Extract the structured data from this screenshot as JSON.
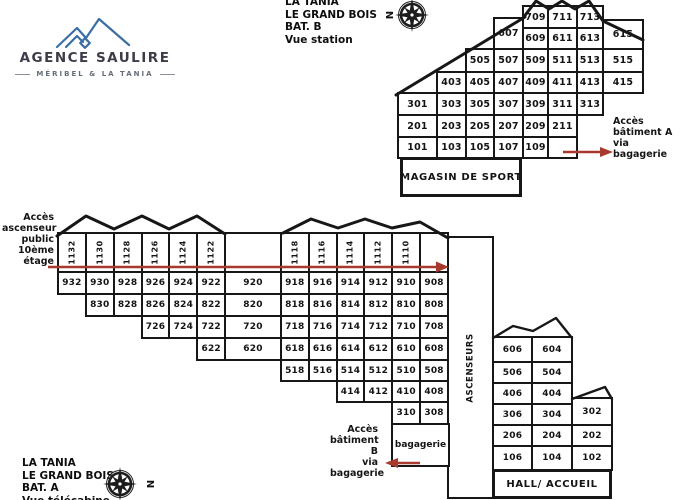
{
  "brand": {
    "name": "AGENCE SAULIRE",
    "tagline": "MÉRIBEL & LA TANIA"
  },
  "legend_top": {
    "lines": [
      "LA TANIA",
      "LE GRAND BOIS",
      "BAT. B",
      "Vue station"
    ]
  },
  "legend_bottom": {
    "lines": [
      "LA TANIA",
      "LE GRAND BOIS",
      "BAT. A",
      "Vue télécabine"
    ]
  },
  "compass": {
    "north_label": "N"
  },
  "notes": {
    "public_elevator": {
      "lines": [
        "Accès",
        "ascenseur",
        "public",
        "10ème",
        "étage"
      ]
    },
    "access_building_a": {
      "lines": [
        "Accès",
        "bâtiment A",
        "via",
        "bagagerie"
      ]
    },
    "access_building_b": {
      "lines": [
        "Accès",
        "bâtiment B",
        "via",
        "bagagerie"
      ]
    }
  },
  "colors": {
    "line": "#171717",
    "arrow": "#a8392e",
    "brand_blue": "#3a6ea5"
  },
  "building_b": {
    "name": "BAT. B",
    "shop_label": "MAGASIN DE SPORT",
    "rows": [
      {
        "row": 7,
        "start": 5,
        "cells": [
          "709",
          "711",
          "713"
        ]
      },
      {
        "row": 6,
        "start": 5,
        "cells": [
          "609",
          "611",
          "613"
        ]
      },
      {
        "row": 5,
        "start": 3,
        "cells": [
          "505",
          "507",
          "509",
          "511",
          "513",
          "515"
        ]
      },
      {
        "row": 4,
        "start": 2,
        "cells": [
          "403",
          "405",
          "407",
          "409",
          "411",
          "413",
          "415"
        ]
      },
      {
        "row": 3,
        "start": 1,
        "cells": [
          "301",
          "303",
          "305",
          "307",
          "309",
          "311",
          "313"
        ]
      },
      {
        "row": 2,
        "start": 1,
        "cells": [
          "201",
          "203",
          "205",
          "207",
          "209",
          "211"
        ]
      },
      {
        "row": 1,
        "start": 1,
        "cells": [
          "101",
          "103",
          "105",
          "107",
          "109",
          ""
        ]
      }
    ],
    "tall_cells": [
      {
        "label": "607",
        "col": 4,
        "y": 18,
        "h": 31
      },
      {
        "label": "615",
        "col": 8,
        "y": 20,
        "h": 29
      }
    ]
  },
  "building_a": {
    "name": "BAT. A",
    "elevators_label": "ASCENSEURS",
    "luggage_label": "bagagerie",
    "hall_label": "HALL/ ACCUEIL",
    "rows": [
      {
        "row": 11,
        "start": 1,
        "vertical": true,
        "cells": [
          "1132",
          "1130",
          "1128",
          "1126",
          "1124",
          "1122",
          {
            "t": "",
            "s": 2
          },
          "1118",
          "1116",
          "1114",
          "1112",
          "1110",
          ""
        ]
      },
      {
        "row": 9,
        "start": 1,
        "cells": [
          "932",
          "930",
          "928",
          "926",
          "924",
          "922",
          {
            "t": "920",
            "s": 2
          },
          "918",
          "916",
          "914",
          "912",
          "910",
          "908"
        ]
      },
      {
        "row": 8,
        "start": 2,
        "cells": [
          "830",
          "828",
          "826",
          "824",
          "822",
          {
            "t": "820",
            "s": 2
          },
          "818",
          "816",
          "814",
          "812",
          "810",
          "808"
        ]
      },
      {
        "row": 7,
        "start": 4,
        "cells": [
          "726",
          "724",
          "722",
          {
            "t": "720",
            "s": 2
          },
          "718",
          "716",
          "714",
          "712",
          "710",
          "708"
        ]
      },
      {
        "row": 6,
        "start": 6,
        "cells": [
          "622",
          {
            "t": "620",
            "s": 2
          },
          "618",
          "616",
          "614",
          "612",
          "610",
          "608"
        ]
      },
      {
        "row": 5,
        "start": 9,
        "cells": [
          "518",
          "516",
          "514",
          "512",
          "510",
          "508"
        ]
      },
      {
        "row": 4,
        "start": 11,
        "cells": [
          "414",
          "412",
          "410",
          "408"
        ]
      },
      {
        "row": 3,
        "start": 13,
        "cells": [
          "310",
          "308"
        ]
      }
    ],
    "right_wing_rows": [
      {
        "row": 6,
        "cells": [
          "606",
          "604"
        ]
      },
      {
        "row": 5,
        "cells": [
          "506",
          "504"
        ]
      },
      {
        "row": 4,
        "cells": [
          "406",
          "404"
        ]
      },
      {
        "row": 3,
        "cells": [
          "306",
          "304",
          "302"
        ]
      },
      {
        "row": 2,
        "cells": [
          "206",
          "204",
          "202"
        ]
      },
      {
        "row": 1,
        "cells": [
          "106",
          "104",
          "102"
        ]
      }
    ]
  }
}
